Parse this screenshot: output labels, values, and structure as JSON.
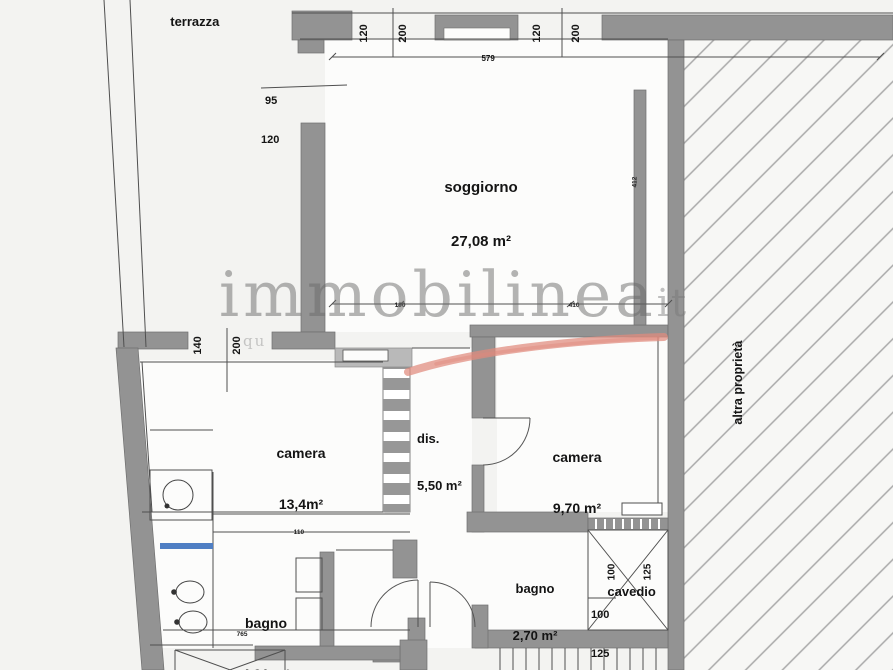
{
  "plan": {
    "watermark": {
      "brand": "immobilinea",
      "tld": "it",
      "subtext": "qu"
    },
    "rooms": {
      "terrazza": {
        "label": "terrazza",
        "area": ""
      },
      "soggiorno": {
        "label": "soggiorno",
        "area": "27,08 m²"
      },
      "camera_grande": {
        "label": "camera",
        "area": "13,4m²"
      },
      "disimpegno": {
        "label": "dis.",
        "area": "5,50 m²"
      },
      "camera_piccola": {
        "label": "camera",
        "area": "9,70 m²"
      },
      "bagno_grande": {
        "label": "bagno",
        "area": "4,91 m²"
      },
      "bagno_piccolo": {
        "label": "bagno",
        "area": "2,70 m²"
      },
      "cavedio": {
        "label": "cavedio",
        "area": ""
      },
      "altra_proprieta": {
        "label": "altra proprietà",
        "area": ""
      }
    },
    "dimensions": {
      "top_length": "579",
      "window_left": {
        "w": "95",
        "h": "120"
      },
      "door_terrazza": {
        "w": "140",
        "h": "200"
      },
      "window_top_a": {
        "w": "120",
        "h": "200"
      },
      "window_top_b": {
        "w": "120",
        "h": "200"
      },
      "soggiorno_depth": "412",
      "seg_a": "190",
      "seg_b": "410",
      "cavedio_plan": {
        "w": "100",
        "h": "125"
      },
      "cavedio_side": {
        "w": "100",
        "h": "125"
      },
      "shaft_bottom": "88",
      "bagno_length": "765",
      "bagno_seg": "110"
    },
    "colors": {
      "paper": "#f3f3f1",
      "room": "#fcfcfb",
      "wall": "#939393",
      "wall_light": "#b9b9b9",
      "line": "#4f4f4f",
      "hatch": "#a9a9a9",
      "red": "#e08a7d",
      "blue": "#4f7fc4",
      "watermark_gray": "#8c8c8c"
    }
  }
}
